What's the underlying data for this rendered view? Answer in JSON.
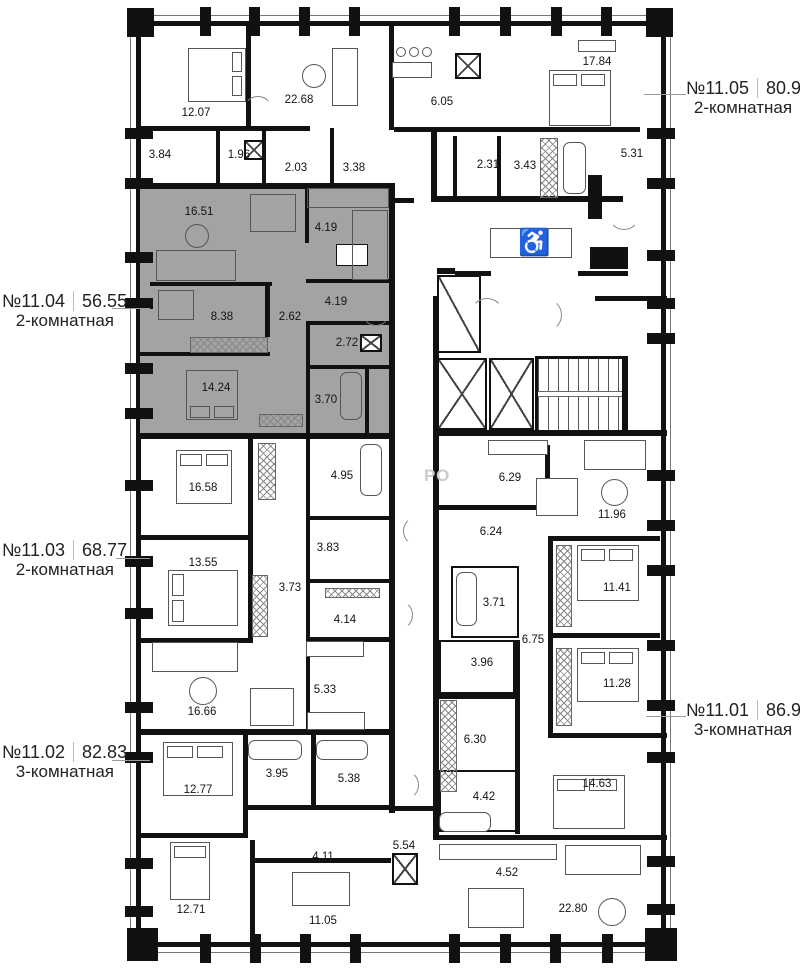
{
  "watermark": "РО",
  "wheelchair_symbol": "♿",
  "apartments": [
    {
      "number": "№11.05",
      "area": "80.90",
      "type": "2-комнатная",
      "rooms": [
        "12.07",
        "22.68",
        "6.05",
        "17.84",
        "3.84",
        "1.96",
        "2.03",
        "3.38",
        "2.31",
        "3.43",
        "5.31"
      ]
    },
    {
      "number": "№11.04",
      "area": "56.55",
      "type": "2-комнатная",
      "highlighted": true,
      "highlight_color": "#a3a3a3",
      "rooms": [
        "16.51",
        "4.19",
        "8.38",
        "2.62",
        "4.19",
        "2.72",
        "14.24",
        "3.70"
      ]
    },
    {
      "number": "№11.03",
      "area": "68.77",
      "type": "2-комнатная",
      "rooms": [
        "16.58",
        "4.95",
        "3.83",
        "13.55",
        "3.73",
        "4.14",
        "5.33",
        "16.66"
      ]
    },
    {
      "number": "№11.02",
      "area": "82.83",
      "type": "3-комнатная",
      "rooms": [
        "12.77",
        "3.95",
        "5.38",
        "4.11",
        "12.71",
        "11.05",
        "5.54",
        "4.52",
        "22.80"
      ]
    },
    {
      "number": "№11.01",
      "area": "86.95",
      "type": "3-комнатная",
      "rooms": [
        "6.29",
        "11.96",
        "6.24",
        "3.71",
        "6.75",
        "3.96",
        "11.41",
        "11.28",
        "6.30",
        "4.42",
        "14.63"
      ]
    }
  ]
}
